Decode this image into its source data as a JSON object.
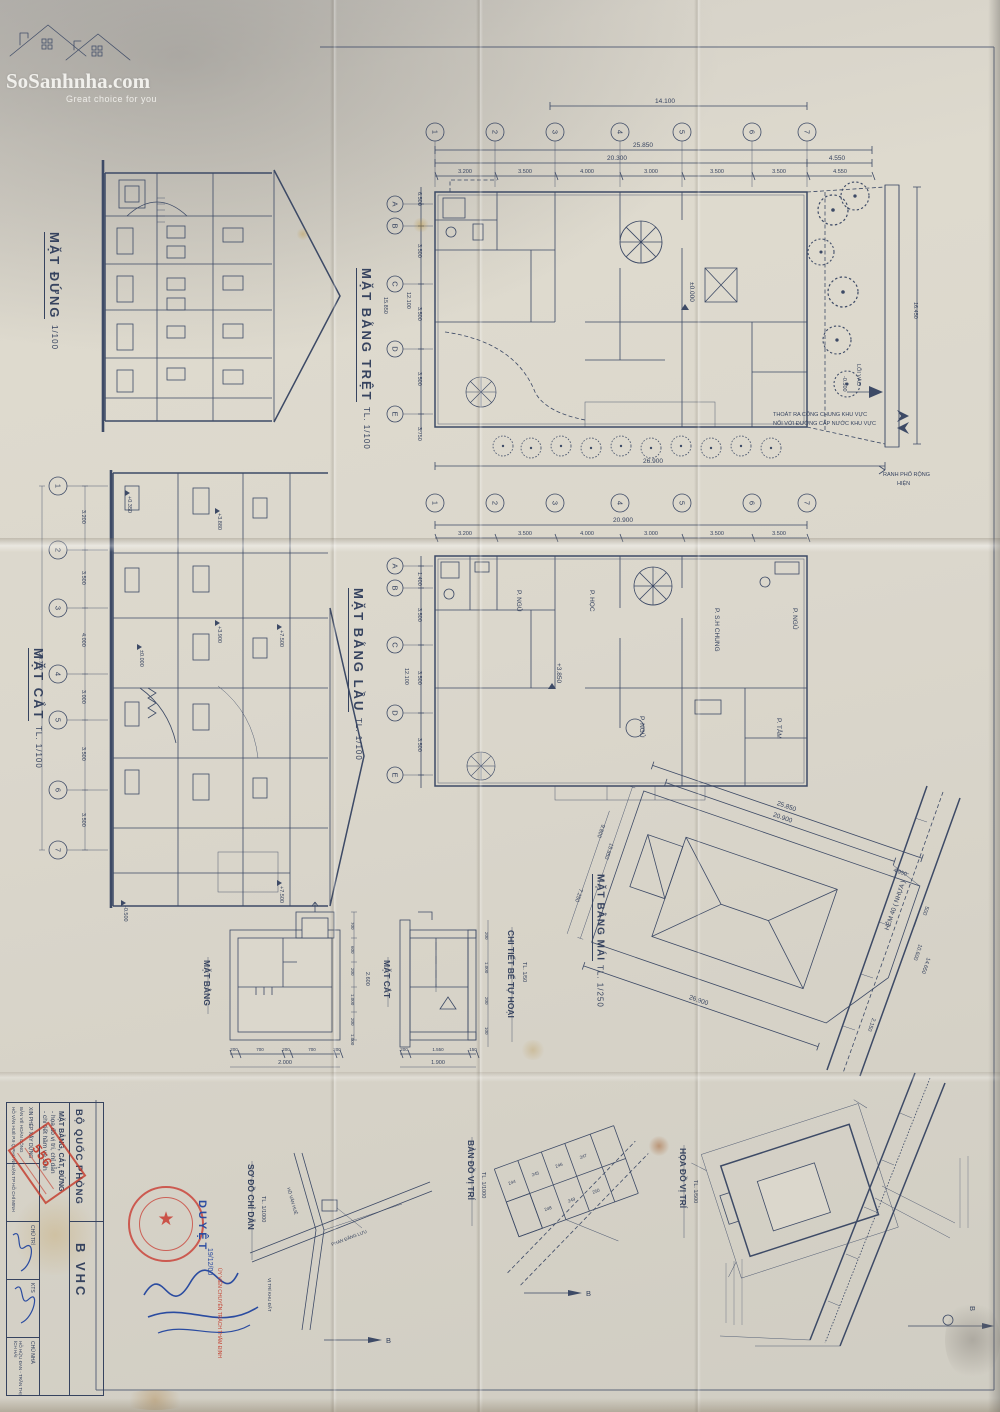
{
  "brand": {
    "name": "SoSanhnha.com",
    "tagline": "Great choice for you"
  },
  "elevation": {
    "title": "MẶT ĐỨNG",
    "scale": "1/100"
  },
  "ground": {
    "title": "MẶT BẰNG TRỆT",
    "scale": "TL. 1/100",
    "cols": [
      "1",
      "2",
      "3",
      "4",
      "5",
      "6",
      "7"
    ],
    "rows": [
      "A",
      "B",
      "C",
      "D",
      "E"
    ],
    "dim_14100": "14.100",
    "dim_25850": "25.850",
    "dim_20300": "20.300",
    "dim_4550": "4.550",
    "bays": [
      "3.200",
      "3.500",
      "4.000",
      "3.000",
      "3.500",
      "3.500",
      "4.550"
    ],
    "side": [
      "6.500",
      "3.500",
      "3.500",
      "3.500",
      "3.750"
    ],
    "side_total": "12.100",
    "side_overall": "15.850",
    "dim_26900": "26.900",
    "dim_16450": "16.450",
    "level": "±0.000",
    "entry": "LỐI VÀO",
    "entry_level": "-0.500",
    "note1": "THOÁT RA CỐNG CHUNG KHU VỰC",
    "note2": "NỐI VỚI ĐƯỜNG CẤP NƯỚC KHU VỰC",
    "note3": "RANH PHỐ RỘNG",
    "note4": "HIỆN"
  },
  "section": {
    "title": "MẶT CẮT",
    "scale": "TL. 1/100",
    "cols": [
      "1",
      "2",
      "3",
      "4",
      "5",
      "6",
      "7"
    ],
    "bays": [
      "3.200",
      "3.500",
      "4.000",
      "3.000",
      "3.500",
      "3.500"
    ],
    "total": "20.700",
    "levels": [
      "+0.350",
      "+3.880",
      "+3.900",
      "+7.500",
      "±0.000",
      "-0.500",
      "+7.500"
    ]
  },
  "upper": {
    "title": "MẶT BẰNG LẦU",
    "scale": "TL. 1/100",
    "cols": [
      "1",
      "2",
      "3",
      "4",
      "5",
      "6",
      "7"
    ],
    "rows": [
      "A",
      "B",
      "C",
      "D",
      "E"
    ],
    "total": "20.900",
    "bays": [
      "3.200",
      "3.500",
      "4.000",
      "3.000",
      "3.500",
      "3.500"
    ],
    "side": [
      "1.400",
      "3.500",
      "3.500",
      "3.500"
    ],
    "side_total": "12.100",
    "level": "+3.850",
    "rooms": [
      "P. NGỦ",
      "P. HỌC",
      "P. S.H CHUNG",
      "P. NGỦ",
      "P. NGỦ",
      "P. TẮM"
    ]
  },
  "roof": {
    "title": "MẶT BẰNG MÁI",
    "scale": "TL. 1/250",
    "d_25850": "25.850",
    "d_20900": "20.900",
    "d_4950": "4.950",
    "d_500": "500",
    "d_10600": "10.600",
    "d_14650": "14.650",
    "d_2150": "2.150",
    "d_26900": "26.900",
    "d_15850": "15.850",
    "d_9800": "9.800",
    "d_7250": "7.250",
    "road": "HẺM 40 ( NHỰA )"
  },
  "septic": {
    "title": "CHI TIẾT BỂ TỰ HOẠI",
    "scale": "TL. 1/50",
    "plan_title": "MẶT BẰNG",
    "section_title": "MẶT CẮT",
    "p_bot": [
      "200",
      "700",
      "200",
      "700",
      "200"
    ],
    "p_bot_total": "2.000",
    "p_right": [
      "700",
      "600",
      "200",
      "1.000",
      "200",
      "1.000"
    ],
    "p_right_total": "2.600",
    "s_bot": [
      "200",
      "1.550",
      "150"
    ],
    "s_bot_total": "1.900",
    "s_right": [
      "200",
      "1.000",
      "200",
      "100"
    ]
  },
  "guide": {
    "title": "SƠ ĐỒ CHỈ DẪN",
    "scale": "TL. 1/1000",
    "north": "B",
    "lot": "VỊ TRÍ KHU ĐẤT",
    "street1": "PHAN ĐĂNG LƯU",
    "street2": "HỒ VĂN HUÊ"
  },
  "locmap": {
    "title": "BẢN ĐỒ VỊ TRÍ",
    "scale": "TL. 1/1000",
    "north": "B",
    "parcels": [
      "244",
      "245",
      "246",
      "247",
      "248",
      "249",
      "250"
    ]
  },
  "sitemap": {
    "title": "HỌA ĐỒ VỊ TRÍ",
    "scale": "TL. 1/500",
    "north": "B"
  },
  "titleblock": {
    "agency": "BỘ QUỐC PHÒNG",
    "permit": "XIN PHÉP XÂY DỰNG",
    "line1": "MẶT BẰNG, CẮT, ĐỨNG",
    "line2": "- họa đồ vị trí, chỉ dẫn",
    "line3": "- chi tiết hầm vệ sinh",
    "code": "B VHC",
    "stamp_no": "556",
    "approve": "DUYỆT",
    "date": "19/12/00",
    "org": "BẢN VẼ HOÀN CÔNG",
    "addr": "HỒ VĂN HUÊ P.9 Q PHÚ NHUẬN TP HỒ CHÍ MINH",
    "role1": "CHỦ TRÌ",
    "role2": "CHỦ NHÀ",
    "sig": "KTS",
    "owner": "HỒ HỮU ĐAN - TRẦN THỊ ÍCH HẢI",
    "red_note": "ỦY VIÊN CHUYÊN TRÁCH THẨM ĐỊNH"
  }
}
